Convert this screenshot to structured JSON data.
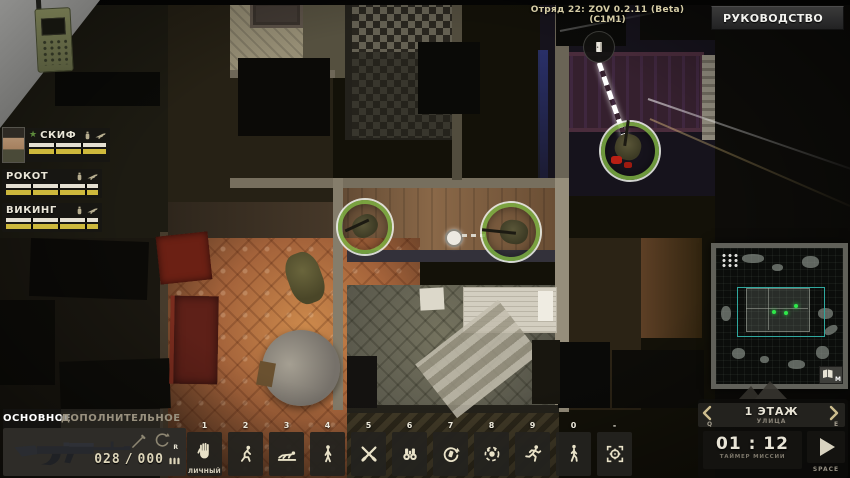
{
  "header": {
    "version_line1": "Отряд 22: ZOV  0.2.11 (Beta)",
    "version_line2": "(C1M1)",
    "manual_button_label": "РУКОВОДСТВО"
  },
  "squad_panel": {
    "members": [
      {
        "name": "СКИФ",
        "leader_star": "★"
      },
      {
        "name": "РОКОТ"
      },
      {
        "name": "ВИКИНГ"
      }
    ]
  },
  "weapon_panel": {
    "tab_primary": "ОСНОВНОЕ",
    "tab_secondary": "ДОПОЛНИТЕЛЬНОЕ",
    "ammo_magazine": "028",
    "ammo_separator": "/",
    "ammo_reserve": "000",
    "reload_key": "R"
  },
  "action_bar": {
    "slots": [
      {
        "key": "1",
        "icon": "hand-icon",
        "label": "ЛИЧНЫЙ"
      },
      {
        "key": "2",
        "icon": "crouch-icon"
      },
      {
        "key": "3",
        "icon": "prone-icon"
      },
      {
        "key": "4",
        "icon": "stand-icon"
      },
      {
        "key": "5",
        "icon": "melee-icon"
      },
      {
        "key": "6",
        "icon": "binoculars-icon"
      },
      {
        "key": "7",
        "icon": "reload-icon"
      },
      {
        "key": "8",
        "icon": "grenade-icon"
      },
      {
        "key": "9",
        "icon": "run-icon"
      },
      {
        "key": "0",
        "icon": "walk-icon"
      },
      {
        "key": "-",
        "icon": "crosshair-icon"
      }
    ]
  },
  "minimap": {
    "map_key": "M"
  },
  "floor_panel": {
    "title": "1 ЭТАЖ",
    "subtitle": "УЛИЦА",
    "prev_key": "Q",
    "next_key": "E"
  },
  "timer_panel": {
    "time": "01 : 12",
    "label": "ТАЙМЕР МИССИИ",
    "play_key": "SPACE"
  },
  "icons": {
    "corner": "radio-icon",
    "scene_marker": "door-icon",
    "squad_member": [
      "grenade-icon",
      "rifle-icon"
    ],
    "accent_colors": {
      "selection_ring": "#7cb042",
      "minimap_unit": "#2ee84a",
      "viewport": "#2fa89e",
      "stamina_bar": "#cdb83c"
    }
  }
}
